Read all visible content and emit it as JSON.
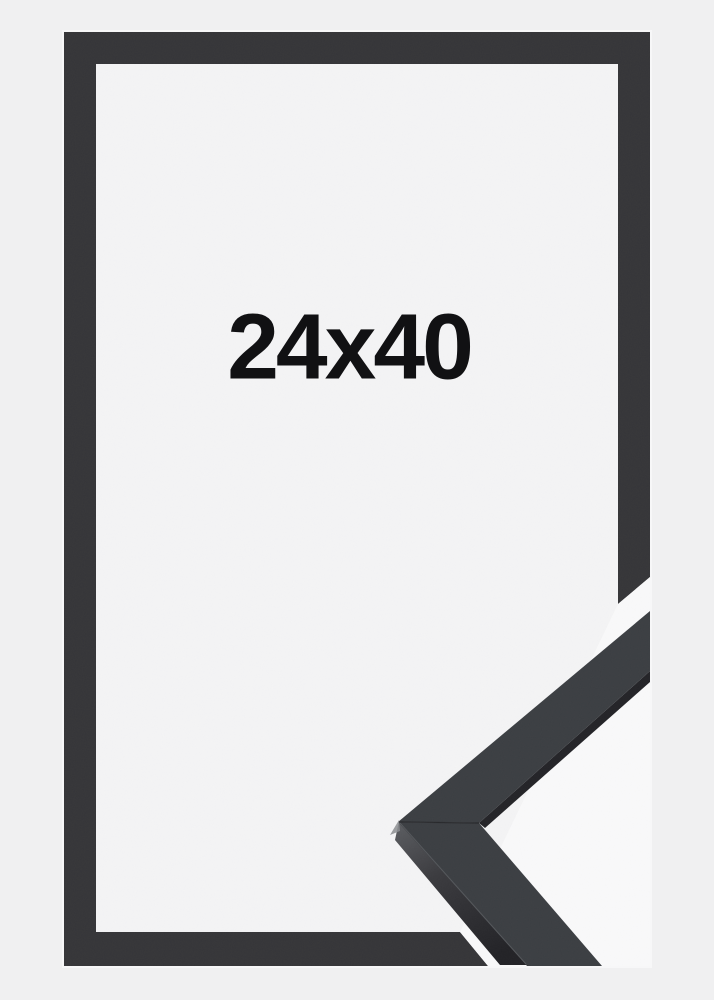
{
  "product_photo": {
    "size_label": "24x40"
  },
  "colors": {
    "page_bg": "#f0f0f1",
    "photo_interior_bg": "#f4f4f5",
    "sample_backdrop": "#f9f9fa",
    "frame": "#353538",
    "sample_face": "#3b3e42",
    "sample_edge_dark": "#232327",
    "label_text": "#111113"
  }
}
